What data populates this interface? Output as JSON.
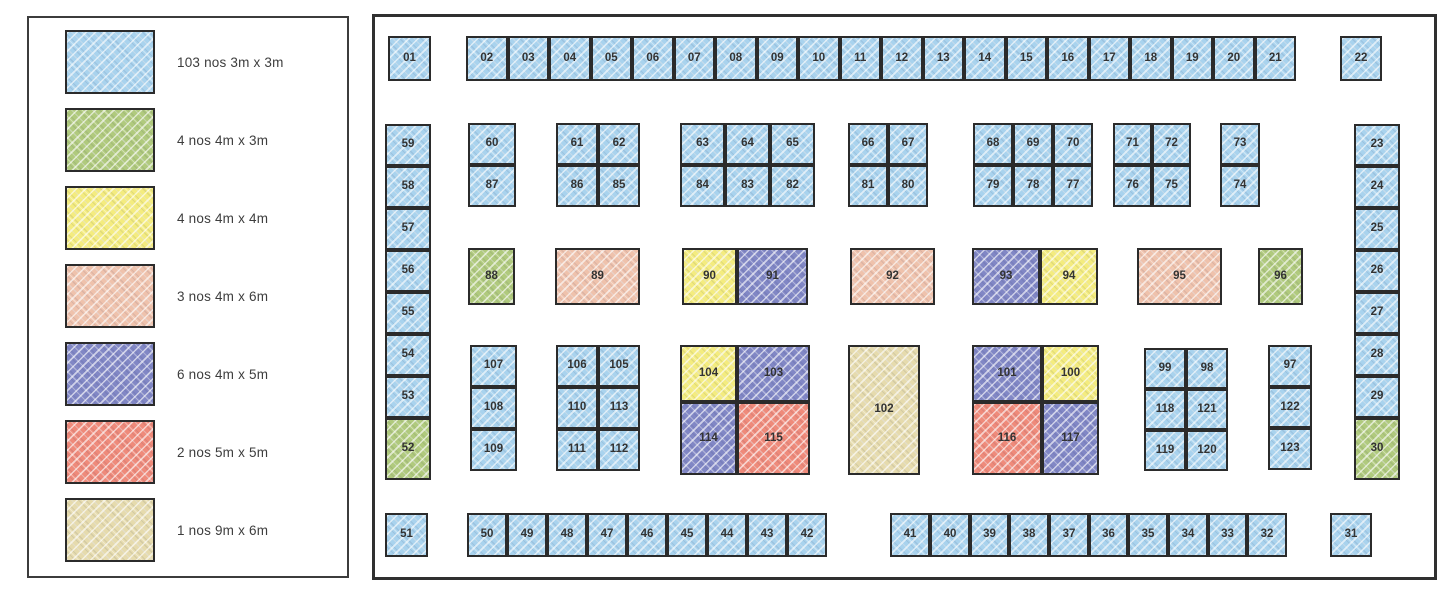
{
  "colors": {
    "b": "#a9d3ee",
    "g": "#b0ca7d",
    "y": "#f4ec7f",
    "s": "#efc2ac",
    "v": "#8187c5",
    "r": "#ef8a7a",
    "t": "#e6dbad"
  },
  "legend": {
    "items": [
      {
        "c": "b",
        "label": "103 nos 3m x 3m"
      },
      {
        "c": "g",
        "label": "4 nos 4m x 3m"
      },
      {
        "c": "y",
        "label": "4 nos 4m x 4m"
      },
      {
        "c": "s",
        "label": "3 nos 4m x 6m"
      },
      {
        "c": "v",
        "label": "6 nos 4m x 5m"
      },
      {
        "c": "r",
        "label": "2 nos 5m x 5m"
      },
      {
        "c": "t",
        "label": "1 nos 9m x 6m"
      }
    ]
  },
  "floorplan": {
    "booths": [
      {
        "n": "01",
        "c": "b",
        "x": 388,
        "y": 36,
        "w": 43,
        "h": 45
      },
      {
        "n": "02",
        "c": "b",
        "x": 466,
        "y": 36,
        "w": 41.5,
        "h": 45
      },
      {
        "n": "03",
        "c": "b",
        "x": 507.5,
        "y": 36,
        "w": 41.5,
        "h": 45
      },
      {
        "n": "04",
        "c": "b",
        "x": 549,
        "y": 36,
        "w": 41.5,
        "h": 45
      },
      {
        "n": "05",
        "c": "b",
        "x": 590.5,
        "y": 36,
        "w": 41.5,
        "h": 45
      },
      {
        "n": "06",
        "c": "b",
        "x": 632,
        "y": 36,
        "w": 41.5,
        "h": 45
      },
      {
        "n": "07",
        "c": "b",
        "x": 673.5,
        "y": 36,
        "w": 41.5,
        "h": 45
      },
      {
        "n": "08",
        "c": "b",
        "x": 715,
        "y": 36,
        "w": 41.5,
        "h": 45
      },
      {
        "n": "09",
        "c": "b",
        "x": 756.5,
        "y": 36,
        "w": 41.5,
        "h": 45
      },
      {
        "n": "10",
        "c": "b",
        "x": 798,
        "y": 36,
        "w": 41.5,
        "h": 45
      },
      {
        "n": "11",
        "c": "b",
        "x": 839.5,
        "y": 36,
        "w": 41.5,
        "h": 45
      },
      {
        "n": "12",
        "c": "b",
        "x": 881,
        "y": 36,
        "w": 41.5,
        "h": 45
      },
      {
        "n": "13",
        "c": "b",
        "x": 922.5,
        "y": 36,
        "w": 41.5,
        "h": 45
      },
      {
        "n": "14",
        "c": "b",
        "x": 964,
        "y": 36,
        "w": 41.5,
        "h": 45
      },
      {
        "n": "15",
        "c": "b",
        "x": 1005.5,
        "y": 36,
        "w": 41.5,
        "h": 45
      },
      {
        "n": "16",
        "c": "b",
        "x": 1047,
        "y": 36,
        "w": 41.5,
        "h": 45
      },
      {
        "n": "17",
        "c": "b",
        "x": 1088.5,
        "y": 36,
        "w": 41.5,
        "h": 45
      },
      {
        "n": "18",
        "c": "b",
        "x": 1130,
        "y": 36,
        "w": 41.5,
        "h": 45
      },
      {
        "n": "19",
        "c": "b",
        "x": 1171.5,
        "y": 36,
        "w": 41.5,
        "h": 45
      },
      {
        "n": "20",
        "c": "b",
        "x": 1213,
        "y": 36,
        "w": 41.5,
        "h": 45
      },
      {
        "n": "21",
        "c": "b",
        "x": 1254.5,
        "y": 36,
        "w": 41.5,
        "h": 45
      },
      {
        "n": "22",
        "c": "b",
        "x": 1340,
        "y": 36,
        "w": 42,
        "h": 45
      },
      {
        "n": "23",
        "c": "b",
        "x": 1354,
        "y": 124,
        "w": 46,
        "h": 42
      },
      {
        "n": "24",
        "c": "b",
        "x": 1354,
        "y": 166,
        "w": 46,
        "h": 42
      },
      {
        "n": "25",
        "c": "b",
        "x": 1354,
        "y": 208,
        "w": 46,
        "h": 42
      },
      {
        "n": "26",
        "c": "b",
        "x": 1354,
        "y": 250,
        "w": 46,
        "h": 42
      },
      {
        "n": "27",
        "c": "b",
        "x": 1354,
        "y": 292,
        "w": 46,
        "h": 42
      },
      {
        "n": "28",
        "c": "b",
        "x": 1354,
        "y": 334,
        "w": 46,
        "h": 42
      },
      {
        "n": "29",
        "c": "b",
        "x": 1354,
        "y": 376,
        "w": 46,
        "h": 42
      },
      {
        "n": "30",
        "c": "g",
        "x": 1354,
        "y": 418,
        "w": 46,
        "h": 62
      },
      {
        "n": "31",
        "c": "b",
        "x": 1330,
        "y": 513,
        "w": 42,
        "h": 44
      },
      {
        "n": "32",
        "c": "b",
        "x": 1247,
        "y": 513,
        "w": 40,
        "h": 44
      },
      {
        "n": "33",
        "c": "b",
        "x": 1208,
        "y": 513,
        "w": 39,
        "h": 44
      },
      {
        "n": "34",
        "c": "b",
        "x": 1168,
        "y": 513,
        "w": 40,
        "h": 44
      },
      {
        "n": "35",
        "c": "b",
        "x": 1128,
        "y": 513,
        "w": 40,
        "h": 44
      },
      {
        "n": "36",
        "c": "b",
        "x": 1089,
        "y": 513,
        "w": 39,
        "h": 44
      },
      {
        "n": "37",
        "c": "b",
        "x": 1049,
        "y": 513,
        "w": 40,
        "h": 44
      },
      {
        "n": "38",
        "c": "b",
        "x": 1009,
        "y": 513,
        "w": 40,
        "h": 44
      },
      {
        "n": "39",
        "c": "b",
        "x": 970,
        "y": 513,
        "w": 39,
        "h": 44
      },
      {
        "n": "40",
        "c": "b",
        "x": 930,
        "y": 513,
        "w": 40,
        "h": 44
      },
      {
        "n": "41",
        "c": "b",
        "x": 890,
        "y": 513,
        "w": 40,
        "h": 44
      },
      {
        "n": "42",
        "c": "b",
        "x": 787,
        "y": 513,
        "w": 40,
        "h": 44
      },
      {
        "n": "43",
        "c": "b",
        "x": 747,
        "y": 513,
        "w": 40,
        "h": 44
      },
      {
        "n": "44",
        "c": "b",
        "x": 707,
        "y": 513,
        "w": 40,
        "h": 44
      },
      {
        "n": "45",
        "c": "b",
        "x": 667,
        "y": 513,
        "w": 40,
        "h": 44
      },
      {
        "n": "46",
        "c": "b",
        "x": 627,
        "y": 513,
        "w": 40,
        "h": 44
      },
      {
        "n": "47",
        "c": "b",
        "x": 587,
        "y": 513,
        "w": 40,
        "h": 44
      },
      {
        "n": "48",
        "c": "b",
        "x": 547,
        "y": 513,
        "w": 40,
        "h": 44
      },
      {
        "n": "49",
        "c": "b",
        "x": 507,
        "y": 513,
        "w": 40,
        "h": 44
      },
      {
        "n": "50",
        "c": "b",
        "x": 467,
        "y": 513,
        "w": 40,
        "h": 44
      },
      {
        "n": "51",
        "c": "b",
        "x": 385,
        "y": 513,
        "w": 43,
        "h": 44
      },
      {
        "n": "52",
        "c": "g",
        "x": 385,
        "y": 418,
        "w": 46,
        "h": 62
      },
      {
        "n": "53",
        "c": "b",
        "x": 385,
        "y": 376,
        "w": 46,
        "h": 42
      },
      {
        "n": "54",
        "c": "b",
        "x": 385,
        "y": 334,
        "w": 46,
        "h": 42
      },
      {
        "n": "55",
        "c": "b",
        "x": 385,
        "y": 292,
        "w": 46,
        "h": 42
      },
      {
        "n": "56",
        "c": "b",
        "x": 385,
        "y": 250,
        "w": 46,
        "h": 42
      },
      {
        "n": "57",
        "c": "b",
        "x": 385,
        "y": 208,
        "w": 46,
        "h": 42
      },
      {
        "n": "58",
        "c": "b",
        "x": 385,
        "y": 166,
        "w": 46,
        "h": 42
      },
      {
        "n": "59",
        "c": "b",
        "x": 385,
        "y": 124,
        "w": 46,
        "h": 42
      },
      {
        "n": "60",
        "c": "b",
        "x": 468,
        "y": 123,
        "w": 48,
        "h": 42
      },
      {
        "n": "61",
        "c": "b",
        "x": 556,
        "y": 123,
        "w": 42,
        "h": 42
      },
      {
        "n": "62",
        "c": "b",
        "x": 598,
        "y": 123,
        "w": 42,
        "h": 42
      },
      {
        "n": "63",
        "c": "b",
        "x": 680,
        "y": 123,
        "w": 45,
        "h": 42
      },
      {
        "n": "64",
        "c": "b",
        "x": 725,
        "y": 123,
        "w": 45,
        "h": 42
      },
      {
        "n": "65",
        "c": "b",
        "x": 770,
        "y": 123,
        "w": 45,
        "h": 42
      },
      {
        "n": "66",
        "c": "b",
        "x": 848,
        "y": 123,
        "w": 40,
        "h": 42
      },
      {
        "n": "67",
        "c": "b",
        "x": 888,
        "y": 123,
        "w": 40,
        "h": 42
      },
      {
        "n": "68",
        "c": "b",
        "x": 973,
        "y": 123,
        "w": 40,
        "h": 42
      },
      {
        "n": "69",
        "c": "b",
        "x": 1013,
        "y": 123,
        "w": 40,
        "h": 42
      },
      {
        "n": "70",
        "c": "b",
        "x": 1053,
        "y": 123,
        "w": 40,
        "h": 42
      },
      {
        "n": "71",
        "c": "b",
        "x": 1113,
        "y": 123,
        "w": 39,
        "h": 42
      },
      {
        "n": "72",
        "c": "b",
        "x": 1152,
        "y": 123,
        "w": 39,
        "h": 42
      },
      {
        "n": "73",
        "c": "b",
        "x": 1220,
        "y": 123,
        "w": 40,
        "h": 42
      },
      {
        "n": "74",
        "c": "b",
        "x": 1220,
        "y": 165,
        "w": 40,
        "h": 42
      },
      {
        "n": "75",
        "c": "b",
        "x": 1152,
        "y": 165,
        "w": 39,
        "h": 42
      },
      {
        "n": "76",
        "c": "b",
        "x": 1113,
        "y": 165,
        "w": 39,
        "h": 42
      },
      {
        "n": "77",
        "c": "b",
        "x": 1053,
        "y": 165,
        "w": 40,
        "h": 42
      },
      {
        "n": "78",
        "c": "b",
        "x": 1013,
        "y": 165,
        "w": 40,
        "h": 42
      },
      {
        "n": "79",
        "c": "b",
        "x": 973,
        "y": 165,
        "w": 40,
        "h": 42
      },
      {
        "n": "80",
        "c": "b",
        "x": 888,
        "y": 165,
        "w": 40,
        "h": 42
      },
      {
        "n": "81",
        "c": "b",
        "x": 848,
        "y": 165,
        "w": 40,
        "h": 42
      },
      {
        "n": "82",
        "c": "b",
        "x": 770,
        "y": 165,
        "w": 45,
        "h": 42
      },
      {
        "n": "83",
        "c": "b",
        "x": 725,
        "y": 165,
        "w": 45,
        "h": 42
      },
      {
        "n": "84",
        "c": "b",
        "x": 680,
        "y": 165,
        "w": 45,
        "h": 42
      },
      {
        "n": "85",
        "c": "b",
        "x": 598,
        "y": 165,
        "w": 42,
        "h": 42
      },
      {
        "n": "86",
        "c": "b",
        "x": 556,
        "y": 165,
        "w": 42,
        "h": 42
      },
      {
        "n": "87",
        "c": "b",
        "x": 468,
        "y": 165,
        "w": 48,
        "h": 42
      },
      {
        "n": "88",
        "c": "g",
        "x": 468,
        "y": 248,
        "w": 47,
        "h": 57
      },
      {
        "n": "89",
        "c": "s",
        "x": 555,
        "y": 248,
        "w": 85,
        "h": 57
      },
      {
        "n": "90",
        "c": "y",
        "x": 682,
        "y": 248,
        "w": 55,
        "h": 57
      },
      {
        "n": "91",
        "c": "v",
        "x": 737,
        "y": 248,
        "w": 71,
        "h": 57
      },
      {
        "n": "92",
        "c": "s",
        "x": 850,
        "y": 248,
        "w": 85,
        "h": 57
      },
      {
        "n": "93",
        "c": "v",
        "x": 972,
        "y": 248,
        "w": 68,
        "h": 57
      },
      {
        "n": "94",
        "c": "y",
        "x": 1040,
        "y": 248,
        "w": 58,
        "h": 57
      },
      {
        "n": "95",
        "c": "s",
        "x": 1137,
        "y": 248,
        "w": 85,
        "h": 57
      },
      {
        "n": "96",
        "c": "g",
        "x": 1258,
        "y": 248,
        "w": 45,
        "h": 57
      },
      {
        "n": "97",
        "c": "b",
        "x": 1268,
        "y": 345,
        "w": 44,
        "h": 42
      },
      {
        "n": "98",
        "c": "b",
        "x": 1186,
        "y": 348,
        "w": 42,
        "h": 41
      },
      {
        "n": "99",
        "c": "b",
        "x": 1144,
        "y": 348,
        "w": 42,
        "h": 41
      },
      {
        "n": "100",
        "c": "y",
        "x": 1042,
        "y": 345,
        "w": 57,
        "h": 57
      },
      {
        "n": "101",
        "c": "v",
        "x": 972,
        "y": 345,
        "w": 70,
        "h": 57
      },
      {
        "n": "102",
        "c": "t",
        "x": 848,
        "y": 345,
        "w": 72,
        "h": 130
      },
      {
        "n": "103",
        "c": "v",
        "x": 737,
        "y": 345,
        "w": 73,
        "h": 57
      },
      {
        "n": "104",
        "c": "y",
        "x": 680,
        "y": 345,
        "w": 57,
        "h": 57
      },
      {
        "n": "105",
        "c": "b",
        "x": 598,
        "y": 345,
        "w": 42,
        "h": 42
      },
      {
        "n": "106",
        "c": "b",
        "x": 556,
        "y": 345,
        "w": 42,
        "h": 42
      },
      {
        "n": "107",
        "c": "b",
        "x": 470,
        "y": 345,
        "w": 47,
        "h": 42
      },
      {
        "n": "108",
        "c": "b",
        "x": 470,
        "y": 387,
        "w": 47,
        "h": 42
      },
      {
        "n": "109",
        "c": "b",
        "x": 470,
        "y": 429,
        "w": 47,
        "h": 42
      },
      {
        "n": "110",
        "c": "b",
        "x": 556,
        "y": 387,
        "w": 42,
        "h": 42
      },
      {
        "n": "111",
        "c": "b",
        "x": 556,
        "y": 429,
        "w": 42,
        "h": 42
      },
      {
        "n": "112",
        "c": "b",
        "x": 598,
        "y": 429,
        "w": 42,
        "h": 42
      },
      {
        "n": "113",
        "c": "b",
        "x": 598,
        "y": 387,
        "w": 42,
        "h": 42
      },
      {
        "n": "114",
        "c": "v",
        "x": 680,
        "y": 402,
        "w": 57,
        "h": 73
      },
      {
        "n": "115",
        "c": "r",
        "x": 737,
        "y": 402,
        "w": 73,
        "h": 73
      },
      {
        "n": "116",
        "c": "r",
        "x": 972,
        "y": 402,
        "w": 70,
        "h": 73
      },
      {
        "n": "117",
        "c": "v",
        "x": 1042,
        "y": 402,
        "w": 57,
        "h": 73
      },
      {
        "n": "118",
        "c": "b",
        "x": 1144,
        "y": 389,
        "w": 42,
        "h": 41
      },
      {
        "n": "119",
        "c": "b",
        "x": 1144,
        "y": 430,
        "w": 42,
        "h": 41
      },
      {
        "n": "120",
        "c": "b",
        "x": 1186,
        "y": 430,
        "w": 42,
        "h": 41
      },
      {
        "n": "121",
        "c": "b",
        "x": 1186,
        "y": 389,
        "w": 42,
        "h": 41
      },
      {
        "n": "122",
        "c": "b",
        "x": 1268,
        "y": 387,
        "w": 44,
        "h": 41
      },
      {
        "n": "123",
        "c": "b",
        "x": 1268,
        "y": 428,
        "w": 44,
        "h": 42
      }
    ]
  }
}
